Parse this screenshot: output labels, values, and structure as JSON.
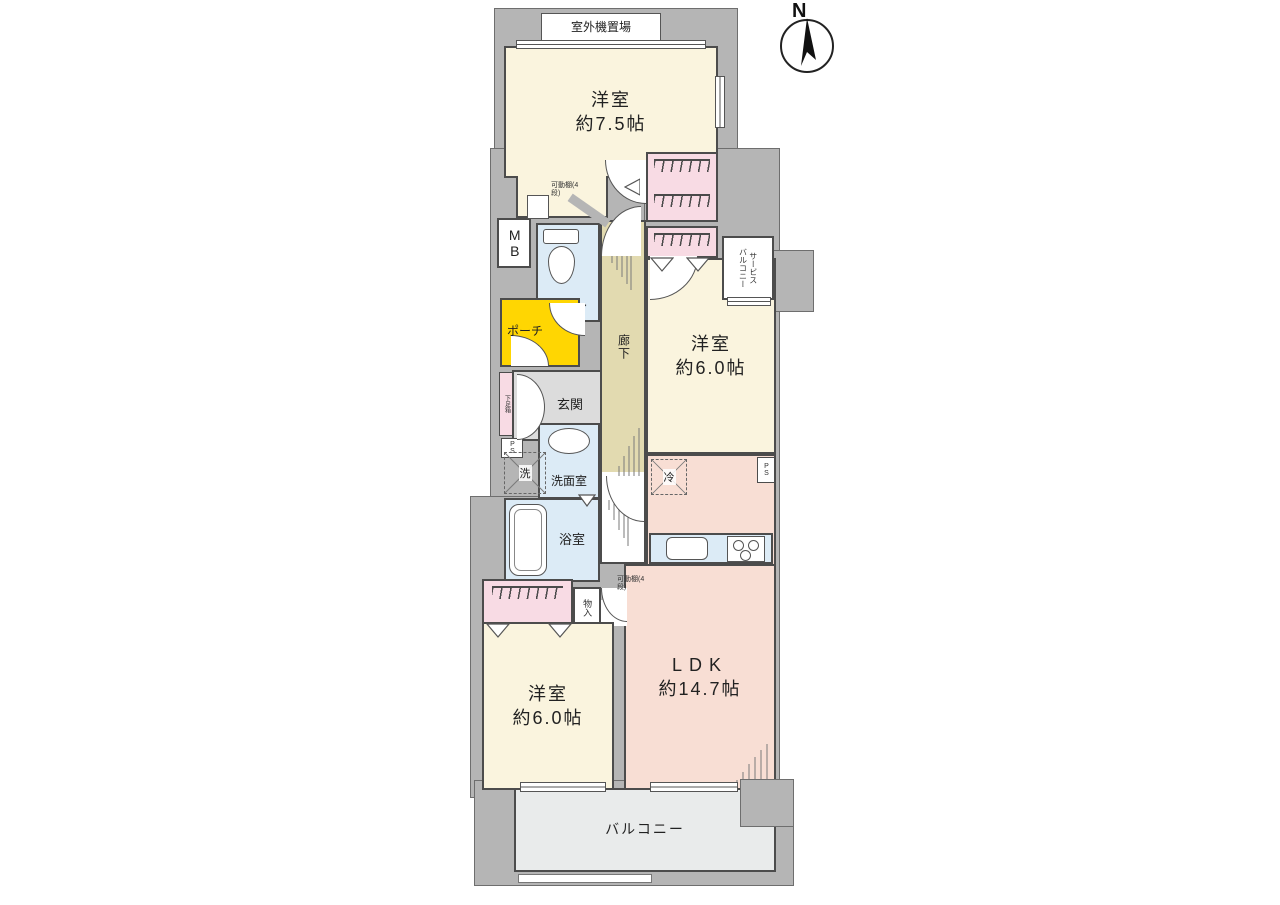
{
  "palette": {
    "wall": "#b5b5b5",
    "cream": "#faf4de",
    "salmon": "#f8ded4",
    "pink": "#f8dbe4",
    "blue": "#dcebf6",
    "yellow": "#ffd602",
    "tan": "#e2dab0",
    "grayroom": "#dcdcdc",
    "balconyfloor": "#e9ebeb",
    "line": "#4c4c4c"
  },
  "compass": {
    "label": "N"
  },
  "labels": {
    "outdoor_unit": "室外機置場",
    "toilet": "トイレ",
    "porch": "ポーチ",
    "entrance": "玄関",
    "shoe_box": "下足箱",
    "washroom": "洗面室",
    "washer": "洗",
    "bath": "浴室",
    "corridor": "廊下",
    "mb": "MB",
    "ps": "PS",
    "fridge": "冷",
    "storage": "物入",
    "movable_shelf": "可動棚(4段)",
    "balcony": "バルコニー",
    "service_balcony": [
      "サービス",
      "バルコニー"
    ]
  },
  "rooms": {
    "bedroom_top": {
      "name": "洋室",
      "size": "約7.5帖"
    },
    "bedroom_right": {
      "name": "洋室",
      "size": "約6.0帖"
    },
    "bedroom_bottom": {
      "name": "洋室",
      "size": "約6.0帖"
    },
    "ldk": {
      "name": "LDK",
      "size": "約14.7帖"
    }
  }
}
